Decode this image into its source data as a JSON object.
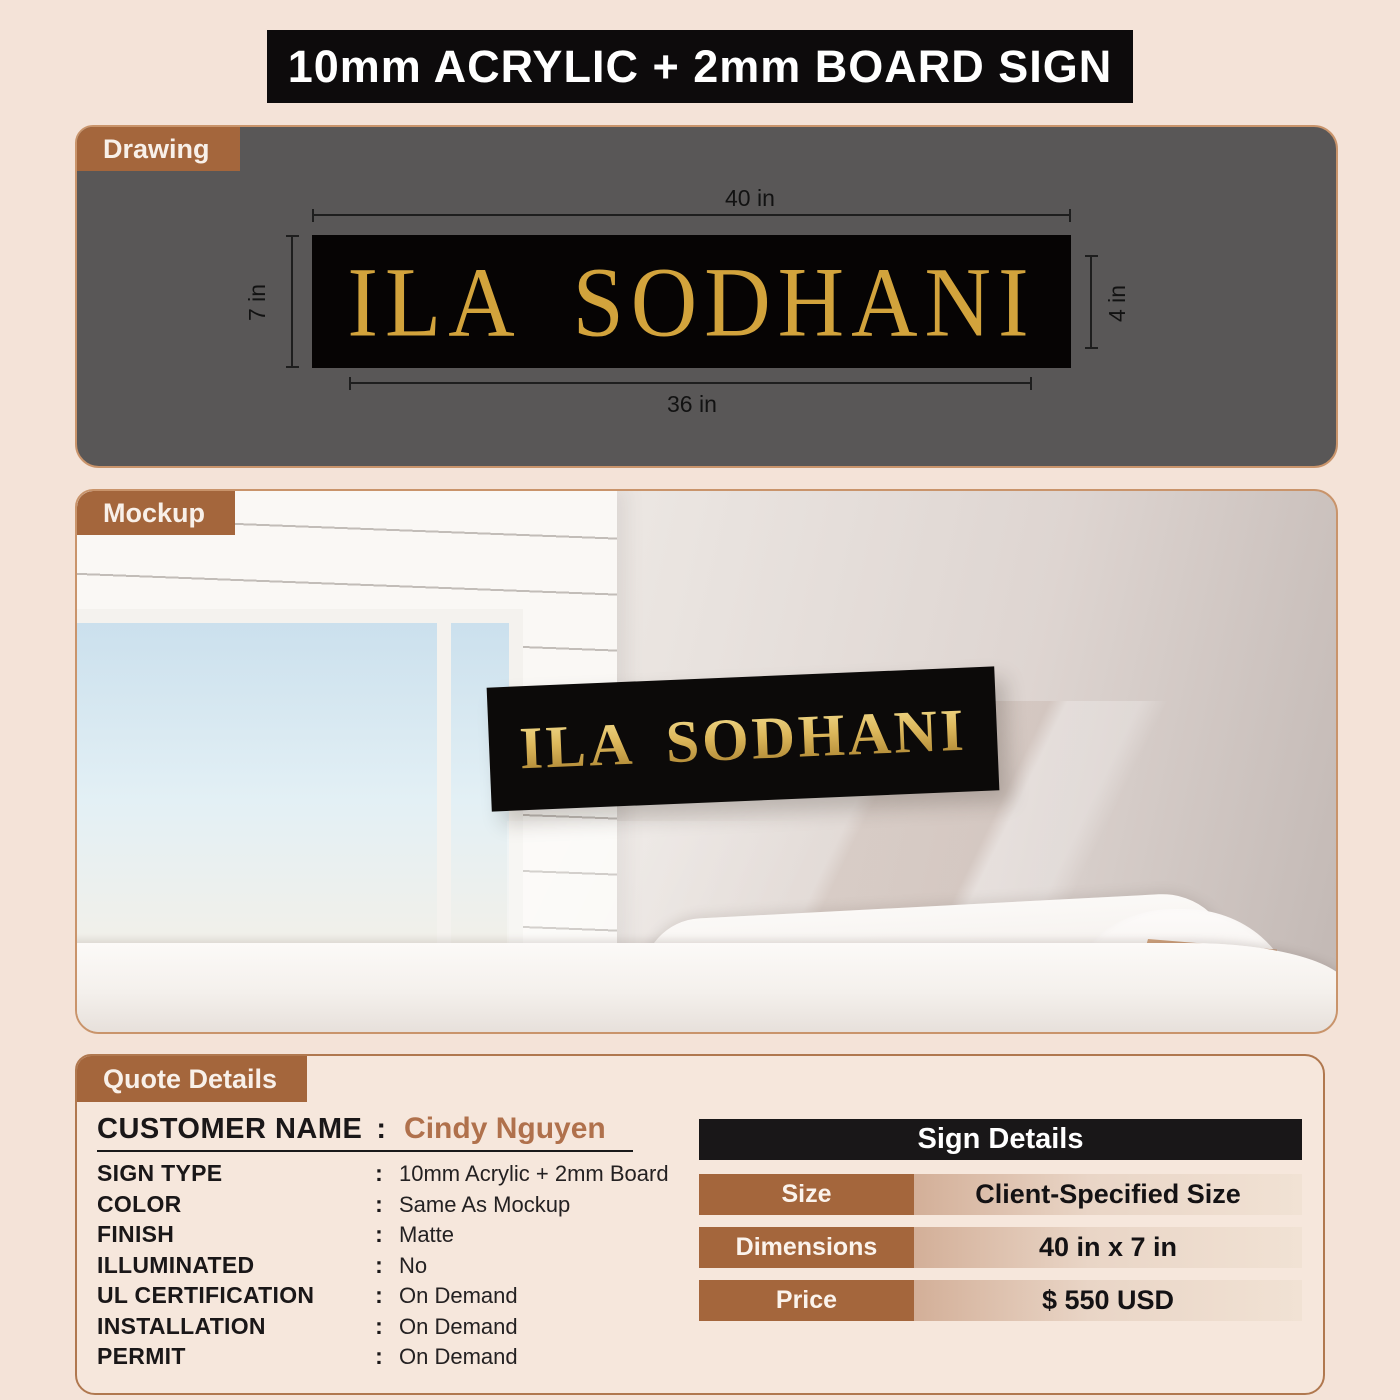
{
  "title": "10mm ACRYLIC + 2mm BOARD SIGN",
  "colors": {
    "page_bg": "#F4E3D8",
    "tab_brown": "#A4663C",
    "drawing_bg": "#595757",
    "sign_black": "#060404",
    "sign_gold": "#D2A33C",
    "accent_border": "#B0784F",
    "customer_name_color": "#B0714C",
    "table_header_bg": "#191718"
  },
  "drawing": {
    "tab": "Drawing",
    "sign_text": "ILA SODHANI",
    "dim_top": "40 in",
    "dim_bottom": "36 in",
    "dim_left": "7 in",
    "dim_right": "4 in"
  },
  "mockup": {
    "tab": "Mockup",
    "sign_text": "ILA SODHANI"
  },
  "quote": {
    "tab": "Quote Details",
    "colon": ":",
    "customer_label": "CUSTOMER NAME",
    "customer_name": "Cindy Nguyen",
    "fields": [
      {
        "label": "SIGN TYPE",
        "value": "10mm Acrylic + 2mm Board"
      },
      {
        "label": "COLOR",
        "value": "Same As Mockup"
      },
      {
        "label": "FINISH",
        "value": "Matte"
      },
      {
        "label": "ILLUMINATED",
        "value": "No"
      },
      {
        "label": "UL CERTIFICATION",
        "value": "On Demand"
      },
      {
        "label": "INSTALLATION",
        "value": "On Demand"
      },
      {
        "label": "PERMIT",
        "value": "On Demand"
      }
    ],
    "table": {
      "header": "Sign Details",
      "rows": [
        {
          "label": "Size",
          "value": "Client-Specified Size"
        },
        {
          "label": "Dimensions",
          "value": "40 in x 7 in"
        },
        {
          "label": "Price",
          "value": "$ 550 USD"
        }
      ]
    }
  }
}
